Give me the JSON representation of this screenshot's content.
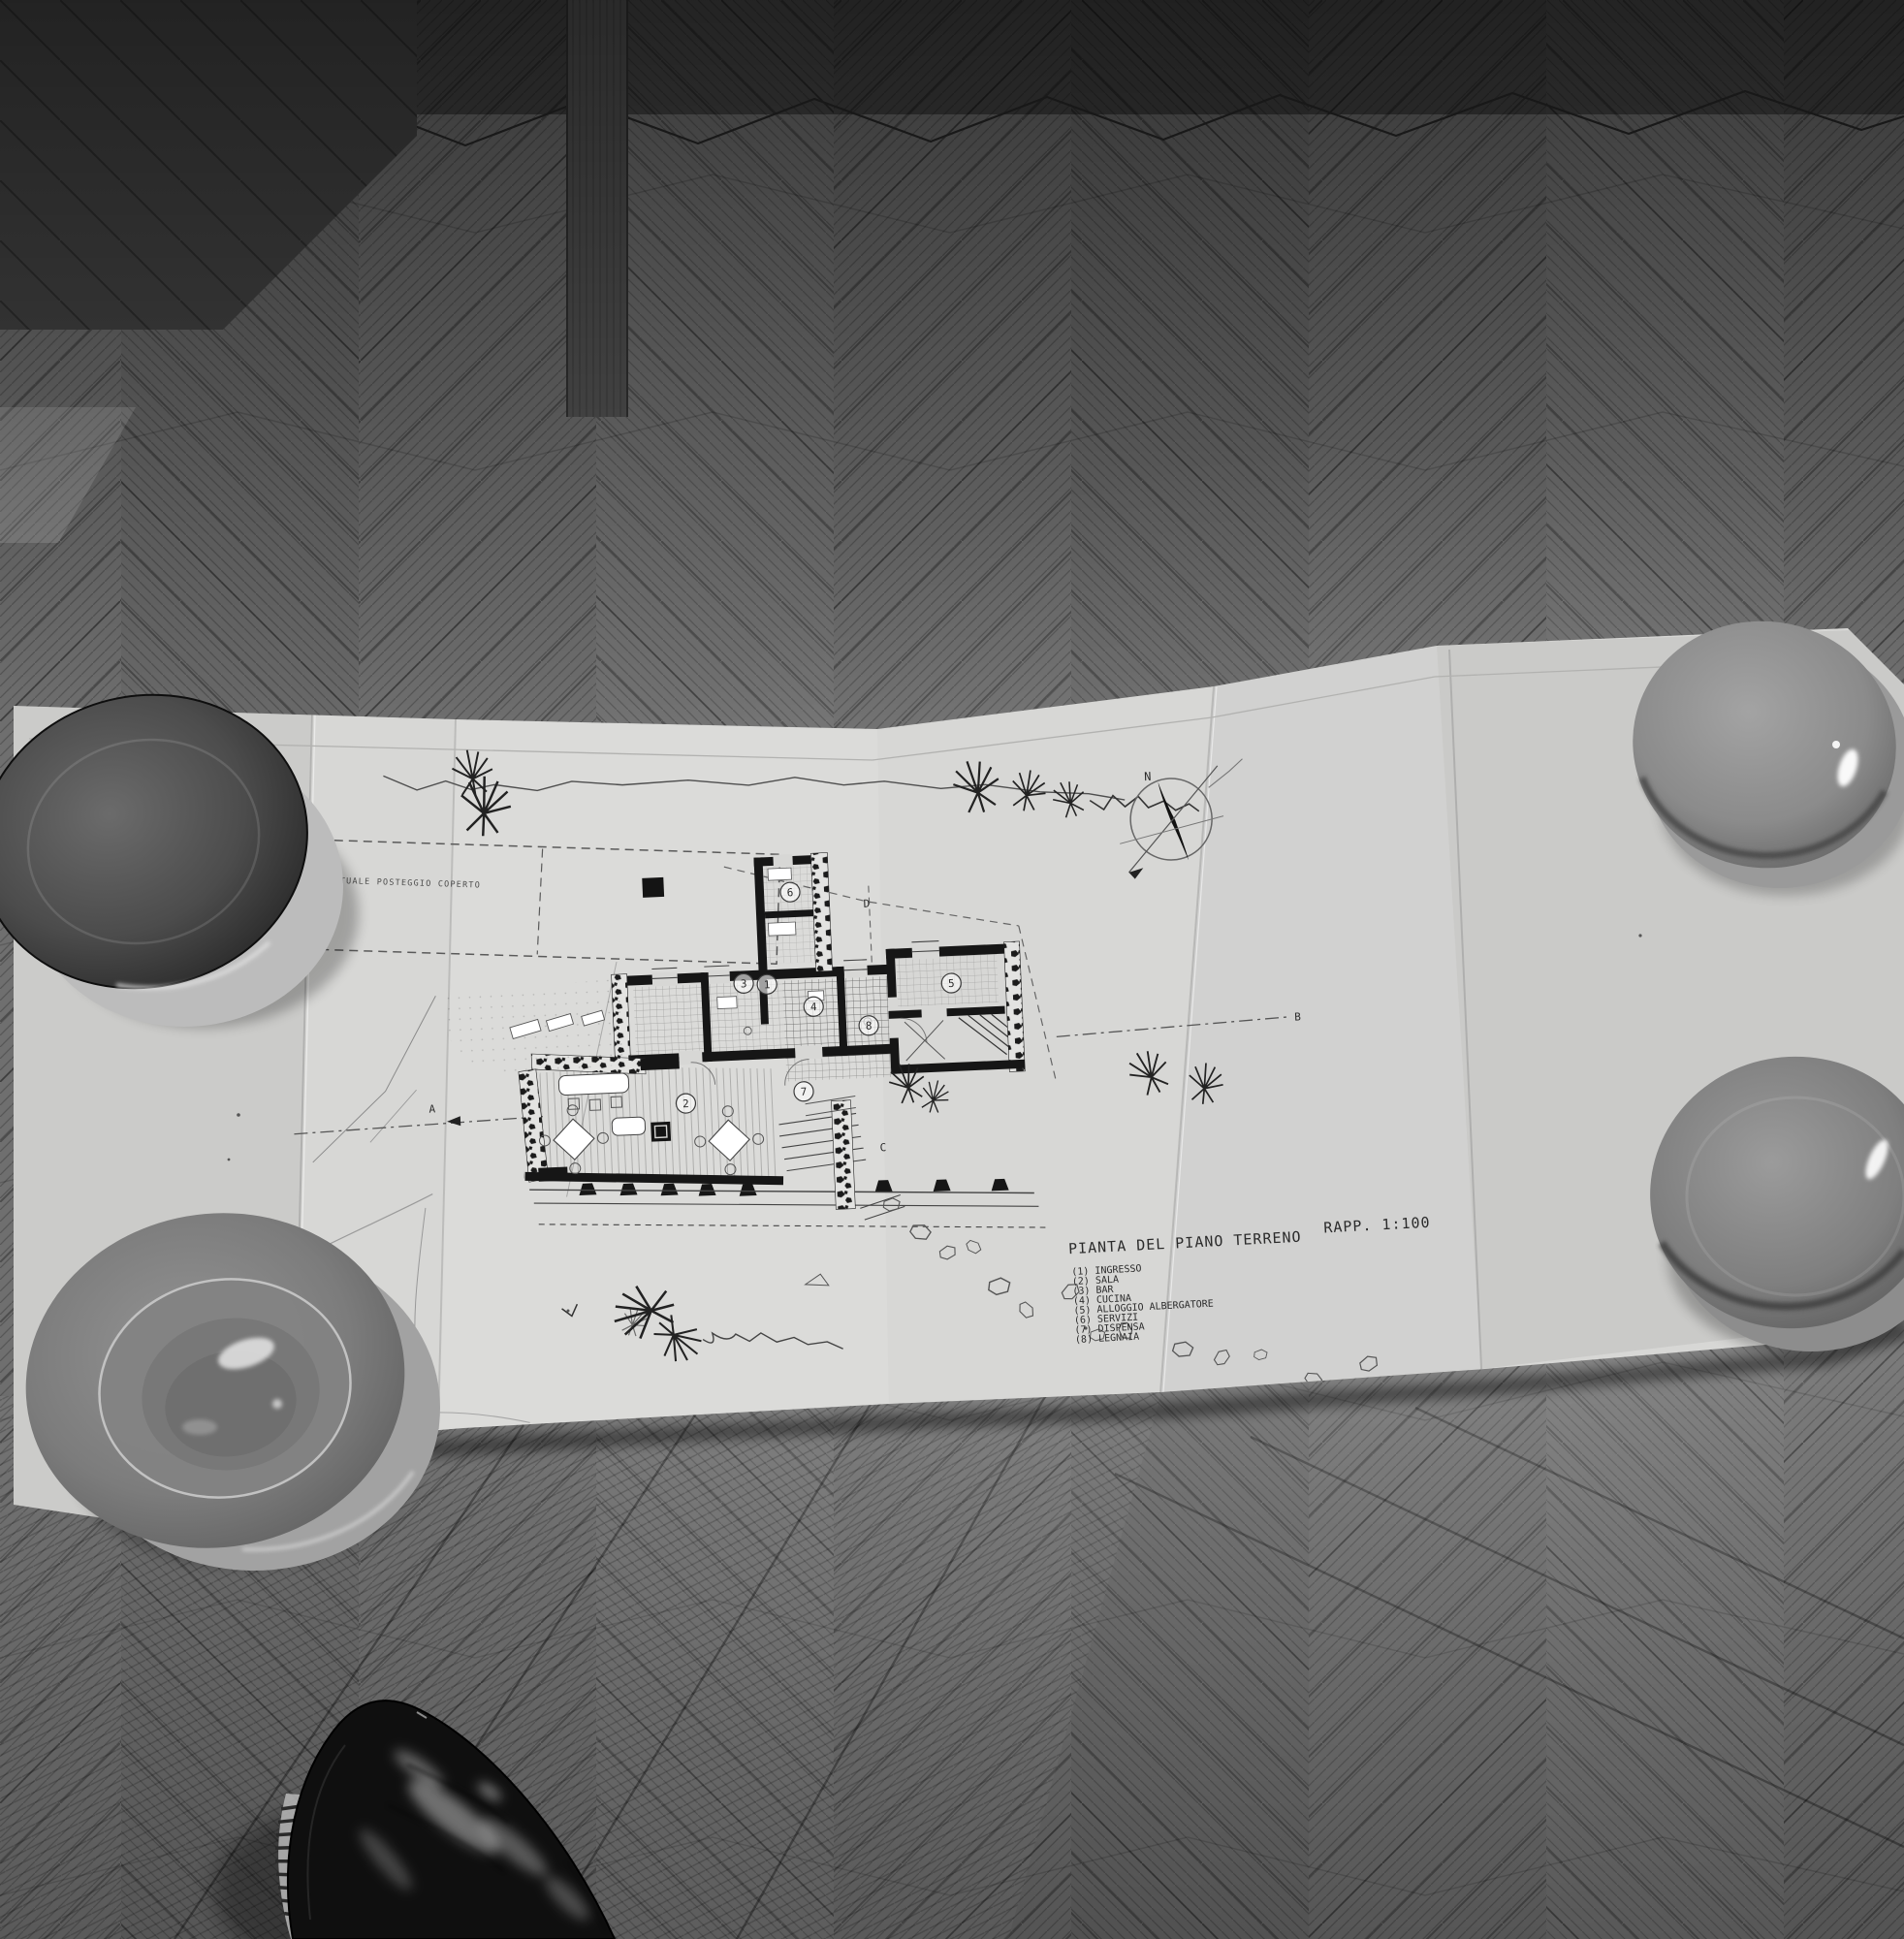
{
  "drawing": {
    "title": "PIANTA DEL PIANO TERRENO",
    "scale_label": "RAPP. 1:100",
    "legend": [
      "(1) INGRESSO",
      "(2) SALA",
      "(3) BAR",
      "(4) CUCINA",
      "(5) ALLOGGIO ALBERGATORE",
      "(6) SERVIZI",
      "(7) DISPENSA",
      "(8) LEGNAIA"
    ],
    "annotation_parking": "EVENTUALE POSTEGGIO COPERTO",
    "compass_north": "N",
    "rooms": [
      "1",
      "2",
      "3",
      "4",
      "5",
      "6",
      "7",
      "8"
    ],
    "sections": [
      "A",
      "B",
      "C",
      "D"
    ]
  },
  "colors": {
    "paper": "#d7d7d5",
    "floor_base": "#6f6f6f",
    "ink": "#2b2b2b",
    "wall_black": "#161616",
    "plate_gray": "#8a8a8a",
    "plate_dark": "#3a3a3a",
    "shoe_black": "#0f0f0f"
  }
}
